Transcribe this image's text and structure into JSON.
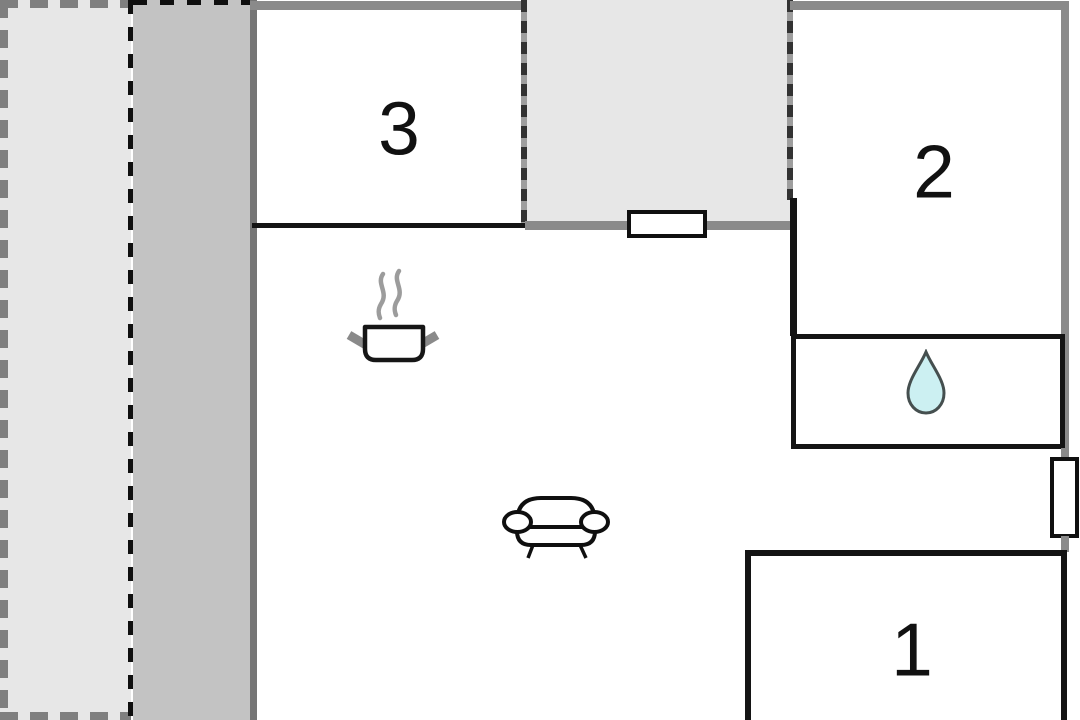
{
  "plan": {
    "rooms": {
      "room1": {
        "label": "1"
      },
      "room2": {
        "label": "2"
      },
      "room3": {
        "label": "3"
      }
    },
    "icons": {
      "kitchen": "cooking-pot-icon",
      "living_room": "sofa-icon",
      "bathroom": "water-drop-icon"
    },
    "features": {
      "windows": 2,
      "dashed_outdoor_zones": 2
    },
    "colors": {
      "outdoor_light": "#e7e7e7",
      "outdoor_shade": "#c3c3c3",
      "wall_gray": "#8a8a8a",
      "wall_dark": "#757575",
      "wall_black": "#141414",
      "drop_fill": "#ccf0f2",
      "drop_stroke": "#454f4f",
      "steam_gray": "#9c9c9c"
    }
  }
}
